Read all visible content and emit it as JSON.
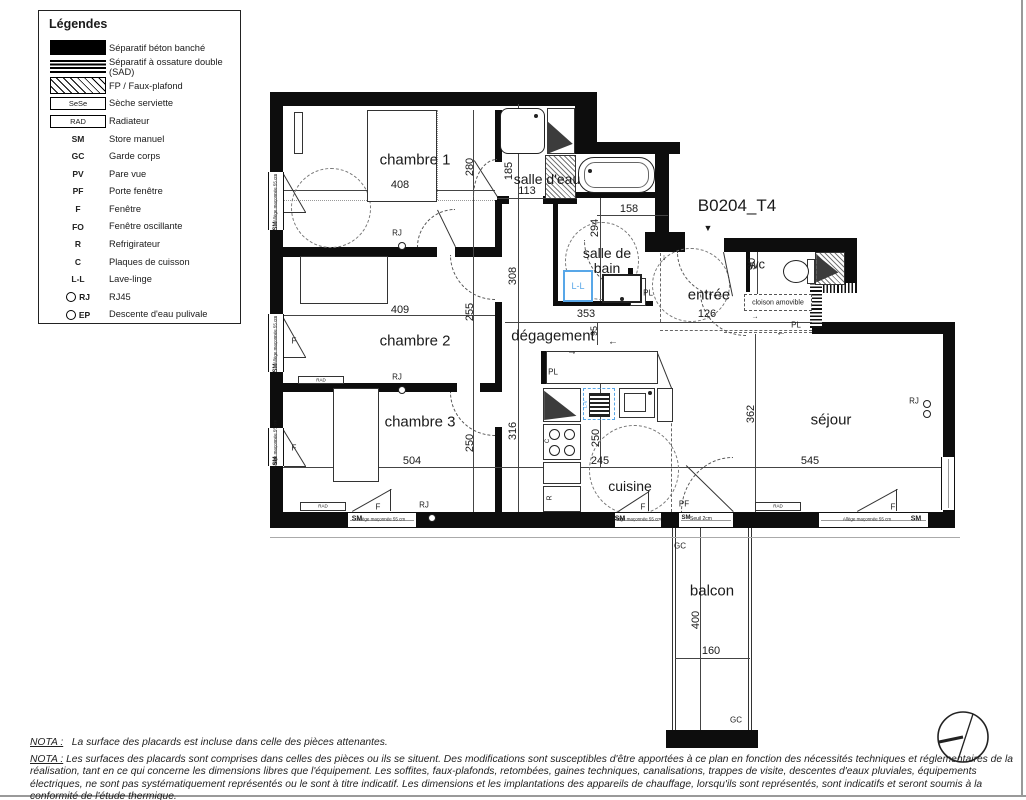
{
  "legend": {
    "title": "Légendes",
    "items": [
      {
        "sym": "solid",
        "code": "",
        "label": "Séparatif béton banché"
      },
      {
        "sym": "sad",
        "code": "",
        "label": "Séparatif à ossature double (SAD)"
      },
      {
        "sym": "hatch",
        "code": "",
        "label": "FP / Faux-plafond"
      },
      {
        "sym": "box",
        "code": "SeSe",
        "label": "Sèche serviette"
      },
      {
        "sym": "box",
        "code": "RAD",
        "label": "Radiateur"
      },
      {
        "sym": "code",
        "code": "SM",
        "label": "Store manuel"
      },
      {
        "sym": "code",
        "code": "GC",
        "label": "Garde corps"
      },
      {
        "sym": "code",
        "code": "PV",
        "label": "Pare vue"
      },
      {
        "sym": "code",
        "code": "PF",
        "label": "Porte fenêtre"
      },
      {
        "sym": "code",
        "code": "F",
        "label": "Fenêtre"
      },
      {
        "sym": "code",
        "code": "FO",
        "label": "Fenêtre oscillante"
      },
      {
        "sym": "code",
        "code": "R",
        "label": "Refrigirateur"
      },
      {
        "sym": "code",
        "code": "C",
        "label": "Plaques de cuisson"
      },
      {
        "sym": "code",
        "code": "L-L",
        "label": "Lave-linge"
      },
      {
        "sym": "circ",
        "code": "RJ",
        "label": "RJ45"
      },
      {
        "sym": "circ",
        "code": "EP",
        "label": "Descente d'eau pulivale"
      }
    ]
  },
  "plan": {
    "unit_title": "B0204_T4",
    "rooms": {
      "chambre1": "chambre 1",
      "chambre2": "chambre 2",
      "chambre3": "chambre 3",
      "salle_eau": "salle d'eau",
      "salle_bain": "salle de bain",
      "wc": "wc",
      "entree": "entrée",
      "degagement": "dégagement",
      "cuisine": "cuisine",
      "sejour": "séjour",
      "balcon": "balcon"
    },
    "dims": {
      "chambre1_w": "408",
      "chambre1_h": "280",
      "salle_eau_w": "113",
      "salle_eau_h": "185",
      "bain_w": "158",
      "bain_h": "294",
      "wc_h": "90",
      "entree_w": "126",
      "deg_h": "308",
      "deg_w": "353",
      "deg_s": "95",
      "chambre2_w": "409",
      "chambre2_h": "255",
      "couloir_h": "316",
      "chambre3_w": "504",
      "chambre3_h": "250",
      "cuisine_w": "245",
      "cuisine_h": "250",
      "sejour_w": "545",
      "sejour_h": "362",
      "balcon_w": "160",
      "balcon_h": "400"
    },
    "tags": {
      "sm": "SM",
      "gc": "GC",
      "f": "F",
      "pf": "PF",
      "pl": "PL",
      "rj": "RJ",
      "rad": "RAD",
      "ll": "L-L",
      "lv": "L-V",
      "c": "C",
      "r": "R",
      "cloison": "cloison amovible",
      "allege": "Allège maçonnée 55 cm",
      "seuil": "Seuil 2cm",
      "pointer": "▼",
      "arrow_right": "→",
      "arrow_left": "←",
      "arrow_down": "↓"
    }
  },
  "notes": {
    "nota1_label": "NOTA :",
    "nota1_text": "La surface des placards est incluse dans celle des pièces attenantes.",
    "nota2_label": "NOTA :",
    "nota2_text": "Les surfaces des placards sont comprises dans celles des pièces ou ils se situent. Des modifications sont susceptibles d'être apportées à ce plan en fonction des nécessités techniques et réglementaires de la réalisation, tant en ce qui concerne les dimensions libres que l'équipement. Les soffites, faux-plafonds, retombées, gaines techniques, canalisations, trappes de visite, descentes d'eaux pluviales, équipements électriques, ne sont pas systématiquement représentés ou le sont à titre indicatif. Les dimensions et les implantations des appareils de chauffage, lorsqu'ils sont représentés, sont indicatifs et seront soumis à la conformité de l'étude thermique."
  }
}
